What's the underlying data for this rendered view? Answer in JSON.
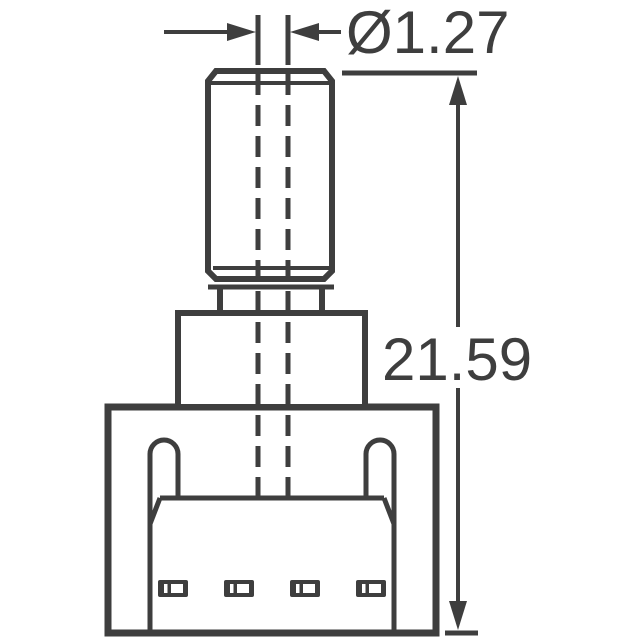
{
  "colors": {
    "line": "#3e3e3e",
    "background": "#ffffff"
  },
  "dimensions": {
    "diameter": {
      "label": "Ø1.27",
      "value": 1.27
    },
    "height": {
      "label": "21.59",
      "value": 21.59
    }
  },
  "features": {
    "terminal_slot_count": 4,
    "mounting_ear_count": 2,
    "centerline_count": 2
  }
}
